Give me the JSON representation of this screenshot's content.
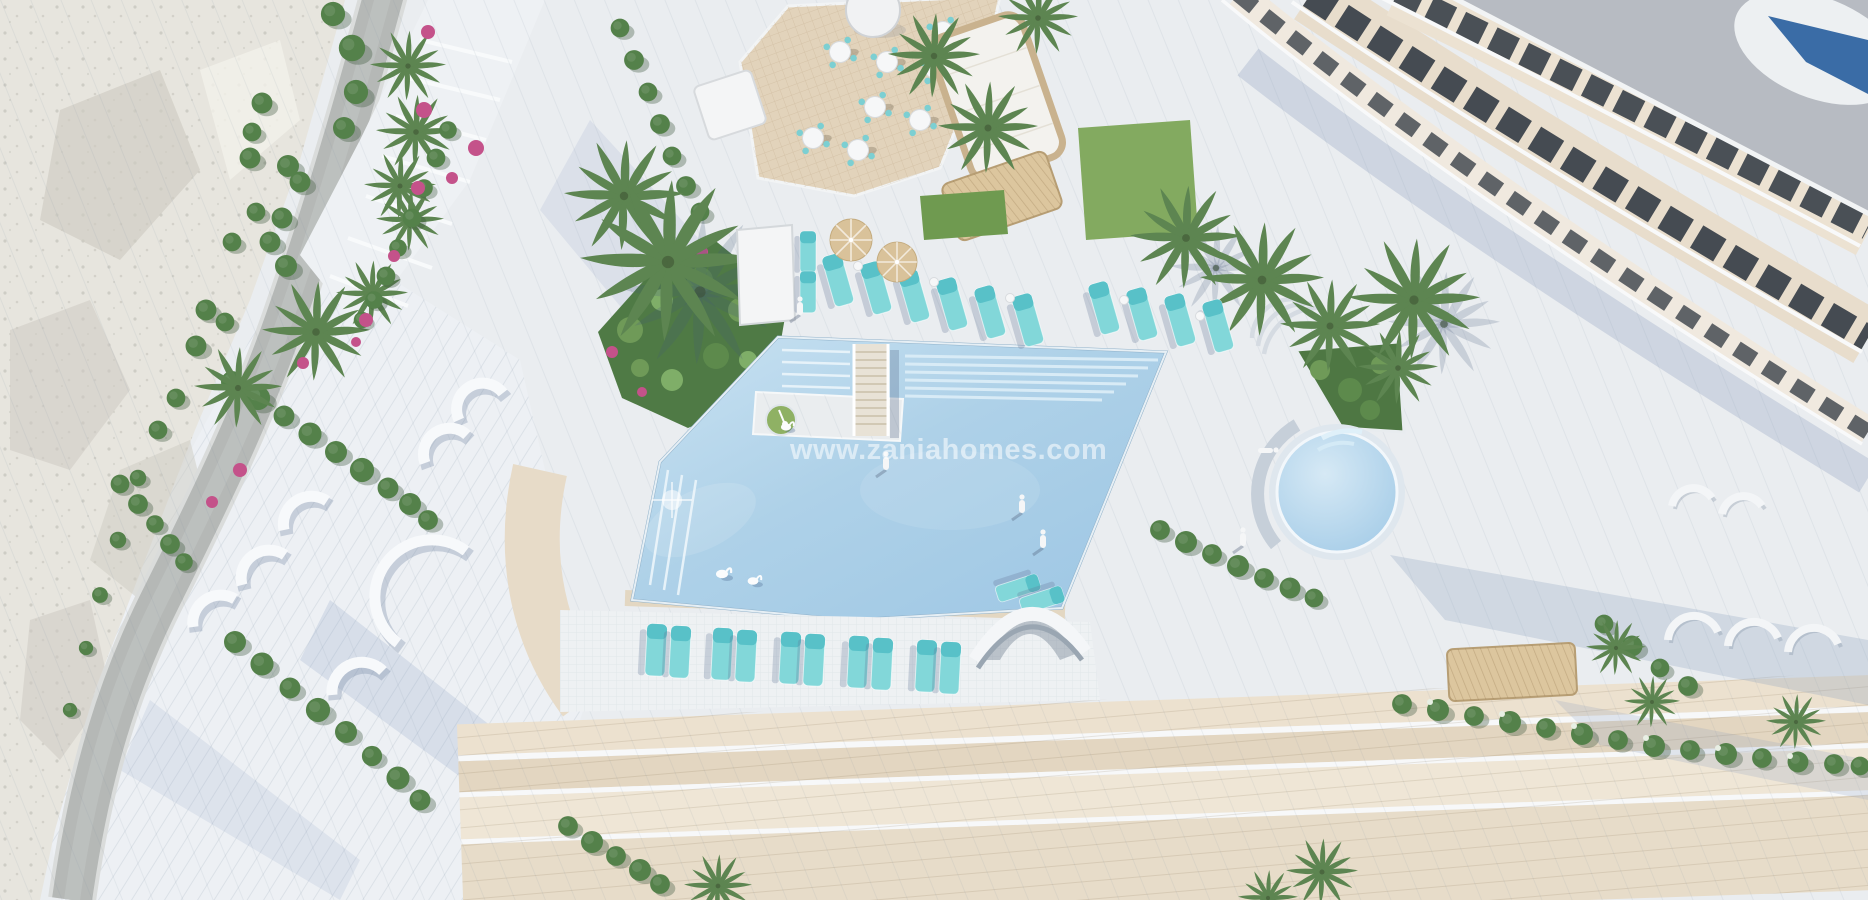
{
  "watermark": {
    "text": "www.zaniahomes.com"
  },
  "palette": {
    "pool_water": "#aed1e8",
    "pool_water_light": "#cfe6f4",
    "pool_water_deep": "#93bfdf",
    "round_pool_water": "#b4d7ec",
    "deck": "#eaedf0",
    "paving_beige": "#e7dbc8",
    "promenade_beige": "#ece2d0",
    "terrace_tan": "#e2d3bb",
    "road_gray": "#b5b8b6",
    "rock_light": "#e7e5de",
    "rock_shade": "#cecbc2",
    "palm_green": "#5d8551",
    "shrub_green": "#54814a",
    "lawn_green": "#83aa60",
    "flower_pink": "#c4528a",
    "lounger_teal": "#82d7d9",
    "lounger_teal_dark": "#58c1c8",
    "parasol_tan": "#d9c29a",
    "wood_frame": "#c9b28e",
    "building_roof_gray": "#b7bbc2",
    "building_window": "#454b52",
    "building_facade": "#e8ddcc",
    "rooftop_pool_blue": "#3a6ca6",
    "white_structure": "#f4f5f6",
    "watermark_color": "rgba(255,255,255,0.55)"
  }
}
